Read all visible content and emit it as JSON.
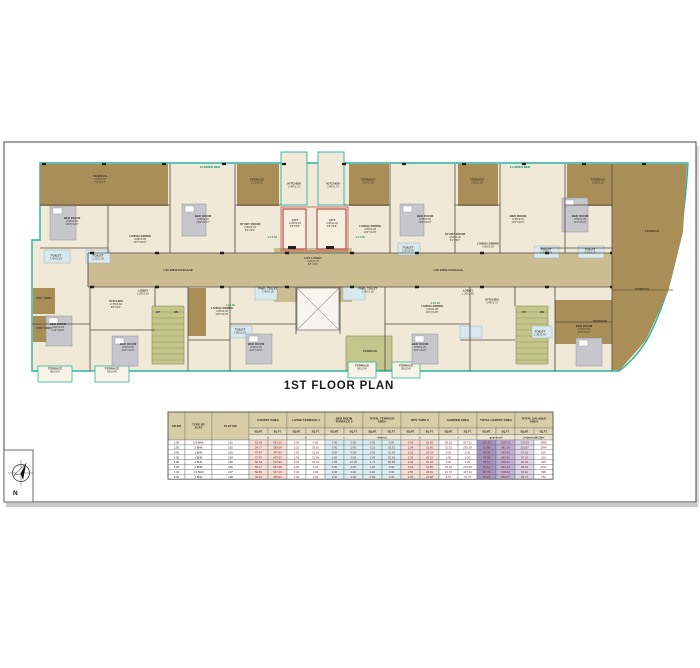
{
  "sheet": {
    "title": "1ST FLOOR PLAN"
  },
  "compass": {
    "north_label": "N"
  },
  "plan": {
    "labels": [
      {
        "t": "FLOWER BED",
        "x": 210,
        "y": 168,
        "c": "t"
      },
      {
        "t": "FLOWER BED",
        "x": 520,
        "y": 168,
        "c": "t"
      },
      {
        "t": "TERRACE",
        "d": "2.13X4.15\n7'0\"X13'7\"",
        "x": 100,
        "y": 180
      },
      {
        "t": "TERRACE",
        "d": "2.13X3.15",
        "x": 257,
        "y": 182
      },
      {
        "t": "TERRACE",
        "d": "3.66X1.50",
        "x": 368,
        "y": 182
      },
      {
        "t": "TERRACE",
        "d": "2.60X1.50",
        "x": 477,
        "y": 182
      },
      {
        "t": "TERRACE",
        "d": "3.66X1.50",
        "x": 598,
        "y": 182
      },
      {
        "t": "TERRACE",
        "x": 652,
        "y": 232
      },
      {
        "t": "TERRACE",
        "x": 642,
        "y": 290
      },
      {
        "t": "TERRACE",
        "x": 600,
        "y": 322
      },
      {
        "t": "BED ROOM",
        "d": "3.05X3.66\n10'0\"X12'0\"",
        "x": 72,
        "y": 222
      },
      {
        "t": "BED ROOM",
        "d": "3.05X3.20\n10'0\"X10'6\"",
        "x": 203,
        "y": 220
      },
      {
        "t": "LIVING/ DINING",
        "d": "3.66X3.05\n12'0\"X10'0\"",
        "x": 140,
        "y": 240
      },
      {
        "t": "TOILET",
        "d": "1.40X2.15",
        "x": 56,
        "y": 258
      },
      {
        "t": "TOILET",
        "d": "2.15X1.20",
        "x": 98,
        "y": 258
      },
      {
        "t": "STUDY ROOM",
        "d": "2.50X2.46\n8'2\"X8'1\"",
        "x": 250,
        "y": 228
      },
      {
        "t": "KITCHEN",
        "d": "2.46X1.75",
        "x": 294,
        "y": 186
      },
      {
        "t": "KITCHEN",
        "d": "2.46X1.75",
        "x": 333,
        "y": 186
      },
      {
        "t": "LIVING/ DINING",
        "d": "3.05X4.48\n10'0\"X14'8\"",
        "x": 370,
        "y": 230
      },
      {
        "t": "BED ROOM",
        "d": "3.05X3.20\n10'0\"X10'6\"",
        "x": 425,
        "y": 220
      },
      {
        "t": "TOILET",
        "d": "1.50X2.40",
        "x": 408,
        "y": 250
      },
      {
        "t": "STUDY ROOM",
        "d": "2.50X2.46\n8'2\"X8'1\"",
        "x": 455,
        "y": 238
      },
      {
        "t": "BED ROOM",
        "d": "3.05X3.20\n10'0\"X10'6\"",
        "x": 518,
        "y": 220
      },
      {
        "t": "LIVING/ DINING",
        "d": "3.66X3.05",
        "x": 488,
        "y": 246
      },
      {
        "t": "BED ROOM",
        "d": "3.05X3.35\n10'0\"X11'0\"",
        "x": 580,
        "y": 220
      },
      {
        "t": "TOILET",
        "d": "1.40X2.15",
        "x": 546,
        "y": 252
      },
      {
        "t": "TOILET",
        "d": "2.15X1.20",
        "x": 590,
        "y": 252
      },
      {
        "t": "LIFT",
        "d": "2.05X2.04\n6'9\"X6'8\"",
        "x": 295,
        "y": 224
      },
      {
        "t": "LIFT",
        "d": "2.05X2.04\n6'9\"X6'8\"",
        "x": 332,
        "y": 224
      },
      {
        "t": "LIFT LOBBY",
        "d": "2.60X2.75\n8'6\"X9'0\"",
        "x": 313,
        "y": 262
      },
      {
        "t": "1.80 WIDE PASSAGE",
        "x": 178,
        "y": 271
      },
      {
        "t": "1.80 WIDE PASSAGE",
        "x": 448,
        "y": 271
      },
      {
        "t": "LOBBY",
        "d": "1.20X2.60",
        "x": 143,
        "y": 293
      },
      {
        "t": "KITCHEN",
        "d": "2.75X1.84\n9'0\"X6'0\"",
        "x": 116,
        "y": 305
      },
      {
        "t": "PWD. TOILET",
        "d": "1.40X1.20",
        "x": 268,
        "y": 291
      },
      {
        "t": "PWD. TOILET",
        "d": "1.40X1.20",
        "x": 368,
        "y": 291
      },
      {
        "t": "LIVING/ DINING",
        "d": "3.05X4.48\n10'0\"X14'8\"",
        "x": 222,
        "y": 312
      },
      {
        "t": "BED ROOM",
        "d": "3.05X3.20\n10'0\"X10'6\"",
        "x": 256,
        "y": 348
      },
      {
        "t": "BED ROOM",
        "d": "3.00X3.05\n9'10\"X10'0\"",
        "x": 58,
        "y": 328
      },
      {
        "t": "BED ROOM",
        "d": "3.05X3.66\n10'0\"X12'0\"",
        "x": 128,
        "y": 348
      },
      {
        "t": "TOILET",
        "d": "1.80X1.20",
        "x": 240,
        "y": 332
      },
      {
        "t": "LIVING/ DINING",
        "d": "3.05X4.48\n10'0\"X14'8\"",
        "x": 432,
        "y": 310
      },
      {
        "t": "BED ROOM",
        "d": "3.05X3.20\n10'0\"X10'6\"",
        "x": 420,
        "y": 348
      },
      {
        "t": "KITCHEN",
        "d": "2.46X1.75",
        "x": 492,
        "y": 302
      },
      {
        "t": "LOBBY",
        "d": "1.20X2.60",
        "x": 468,
        "y": 293
      },
      {
        "t": "BED ROOM",
        "d": "3.05X3.35\n10'0\"X11'0\"",
        "x": 584,
        "y": 330
      },
      {
        "t": "TOILET",
        "d": "1.50X2.40",
        "x": 540,
        "y": 334
      },
      {
        "t": "TERRACE",
        "x": 370,
        "y": 352
      },
      {
        "t": "UP",
        "x": 158,
        "y": 313
      },
      {
        "t": "DN",
        "x": 176,
        "y": 313
      },
      {
        "t": "UP",
        "x": 524,
        "y": 313
      },
      {
        "t": "DN",
        "x": 542,
        "y": 313
      },
      {
        "t": "DRY YARD",
        "x": 44,
        "y": 299
      },
      {
        "t": "DRY YARD",
        "x": 44,
        "y": 329
      },
      {
        "t": "TERRACE",
        "d": "BELOW",
        "x": 55,
        "y": 371
      },
      {
        "t": "TERRACE",
        "d": "BELOW",
        "x": 112,
        "y": 371
      },
      {
        "t": "TERRACE",
        "d": "BELOW",
        "x": 362,
        "y": 368
      },
      {
        "t": "TERRACE",
        "d": "BELOW",
        "x": 406,
        "y": 368
      },
      {
        "t": "1.15 M",
        "x": 272,
        "y": 238,
        "c": "g"
      },
      {
        "t": "1.15 M",
        "x": 360,
        "y": 238,
        "c": "g"
      },
      {
        "t": "1.15 M",
        "x": 230,
        "y": 306,
        "c": "g"
      },
      {
        "t": "1.15 M",
        "x": 435,
        "y": 304,
        "c": "g"
      }
    ]
  },
  "table": {
    "header_groups": [
      "SR.NO",
      "TYPE OF\nFLAT",
      "FLAT NO",
      "CARPET AREA",
      "LIVING TERRACE 1",
      "BED ROOM\nTERRACE 2",
      "TOTAL TERRACE\nAREA",
      "DRY YARD 3",
      "GARDEN AREA",
      "TOTAL CARPET AREA",
      "TOTAL SALABLE\nAREA"
    ],
    "unit_mt": "SQ.MT.",
    "unit_ft": "SQ.FT.",
    "letters": [
      "a",
      "b",
      "c",
      "d=(b+c)",
      "e",
      "f",
      "g=a+d+e+f",
      "h=(a+d+e)X1.33+f"
    ],
    "rows": [
      [
        "1.00",
        "2.5 BHK",
        "101",
        "63.29",
        "681.25",
        "0.00",
        "0.00",
        "0.00",
        "0.00",
        "0.00",
        "0.00",
        "2.94",
        "31.65",
        "85.22",
        "917.31",
        "151.45",
        "1630.21",
        "175.53",
        "1885"
      ],
      [
        "2.00",
        "2 BHK",
        "102",
        "54.77",
        "589.54",
        "3.15",
        "33.91",
        "0.00",
        "0.00",
        "3.15",
        "33.91",
        "2.94",
        "31.65",
        "21.32",
        "230.38",
        "81.88",
        "881.38",
        "101.67",
        "1094"
      ],
      [
        "3.00",
        "1 BHK",
        "103",
        "37.87",
        "407.63",
        "2.93",
        "31.54",
        "0.00",
        "0.00",
        "2.93",
        "31.54",
        "2.25",
        "24.22",
        "0.00",
        "0.00",
        "43.05",
        "463.39",
        "57.16",
        "616"
      ],
      [
        "4.00",
        "1 BHK",
        "104",
        "37.87",
        "407.63",
        "2.93",
        "31.54",
        "0.00",
        "0.00",
        "2.93",
        "31.54",
        "2.25",
        "24.22",
        "0.00",
        "0.00",
        "43.05",
        "463.39",
        "57.16",
        "616"
      ],
      [
        "5.00",
        "2 BHK",
        "105",
        "56.94",
        "612.90",
        "3.15",
        "33.91",
        "1.58",
        "16.95",
        "4.73",
        "50.86",
        "2.94",
        "31.65",
        "0.00",
        "0.00",
        "64.61",
        "695.41",
        "85.93",
        "925"
      ],
      [
        "6.00",
        "2 BHK",
        "106",
        "55.37",
        "597.08",
        "0.00",
        "0.00",
        "0.00",
        "0.00",
        "0.00",
        "0.00",
        "2.94",
        "31.65",
        "20.40",
        "219.58",
        "78.61",
        "846.13",
        "96.04",
        "1034"
      ],
      [
        "7.00",
        "1.5 BHK",
        "107",
        "50.83",
        "547.13",
        "0.00",
        "0.00",
        "0.00",
        "0.00",
        "0.00",
        "0.00",
        "2.50",
        "26.91",
        "12.76",
        "137.34",
        "65.79",
        "708.06",
        "83.42",
        "898"
      ],
      [
        "8.00",
        "1 BHK",
        "108",
        "42.33",
        "455.64",
        "0.00",
        "0.00",
        "0.00",
        "0.00",
        "0.00",
        "0.00",
        "2.20",
        "23.68",
        "6.57",
        "70.75",
        "51.10",
        "550.07",
        "69.77",
        "751"
      ]
    ]
  },
  "colors": {
    "terrace_brown": "#a98e58",
    "room_cream": "#f0e9d7",
    "passage_tan": "#cbbc92",
    "teal_outline": "#2ab3a3",
    "lift_red": "#b5413a",
    "stair_olive": "#c5c68c",
    "toilet_blue": "#d7e9ee",
    "table_header": "#d9cda8",
    "total_carpet_purple": "#a893c1",
    "number_red": "#7b241c"
  }
}
